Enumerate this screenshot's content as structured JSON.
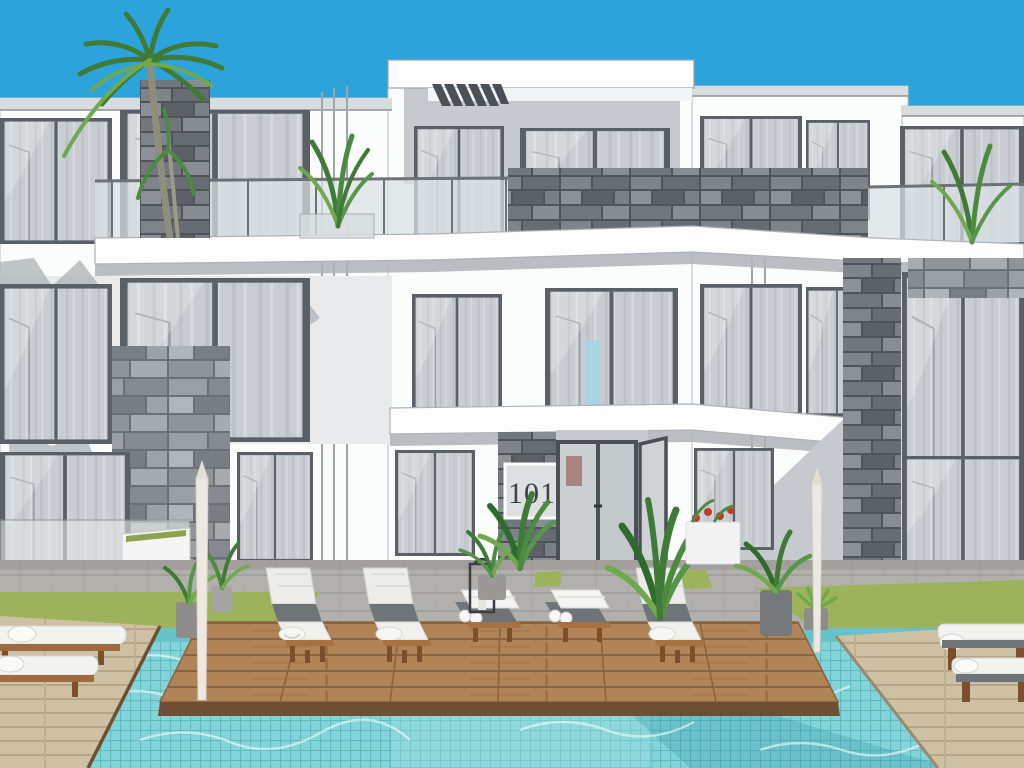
{
  "scene": {
    "description": "3D architectural rendering of a modern two-storey white apartment building with stone cladding, pool deck, lounge chairs and swimming pool",
    "unit_plaque": "101"
  },
  "palette": {
    "sky": "#2CA4DB",
    "facade": "#FBFCFC",
    "facade_shadow": "#C6CACE",
    "window_frame": "#5A6166",
    "curtain": "#C9CDD1",
    "stone_gray": "#8E9498",
    "pool_water": "#82D4D8",
    "pool_shadow": "#2E8FA0",
    "grass": "#9CB35B",
    "deck_wood": "#B08457",
    "deck_wood_dark": "#6E4F33",
    "paving_beige": "#CEC0A3",
    "pavement": "#B2B0AC",
    "towel": "#F6F6F4",
    "cushion_dark": "#6E7478",
    "chair_wood": "#7C4E2B",
    "foliage": "#3F7A36",
    "foliage_light": "#6FA84F",
    "flower_red": "#C03A2E",
    "plaque_bg": "#DDE0E1",
    "plaque_text": "#3B4247"
  }
}
